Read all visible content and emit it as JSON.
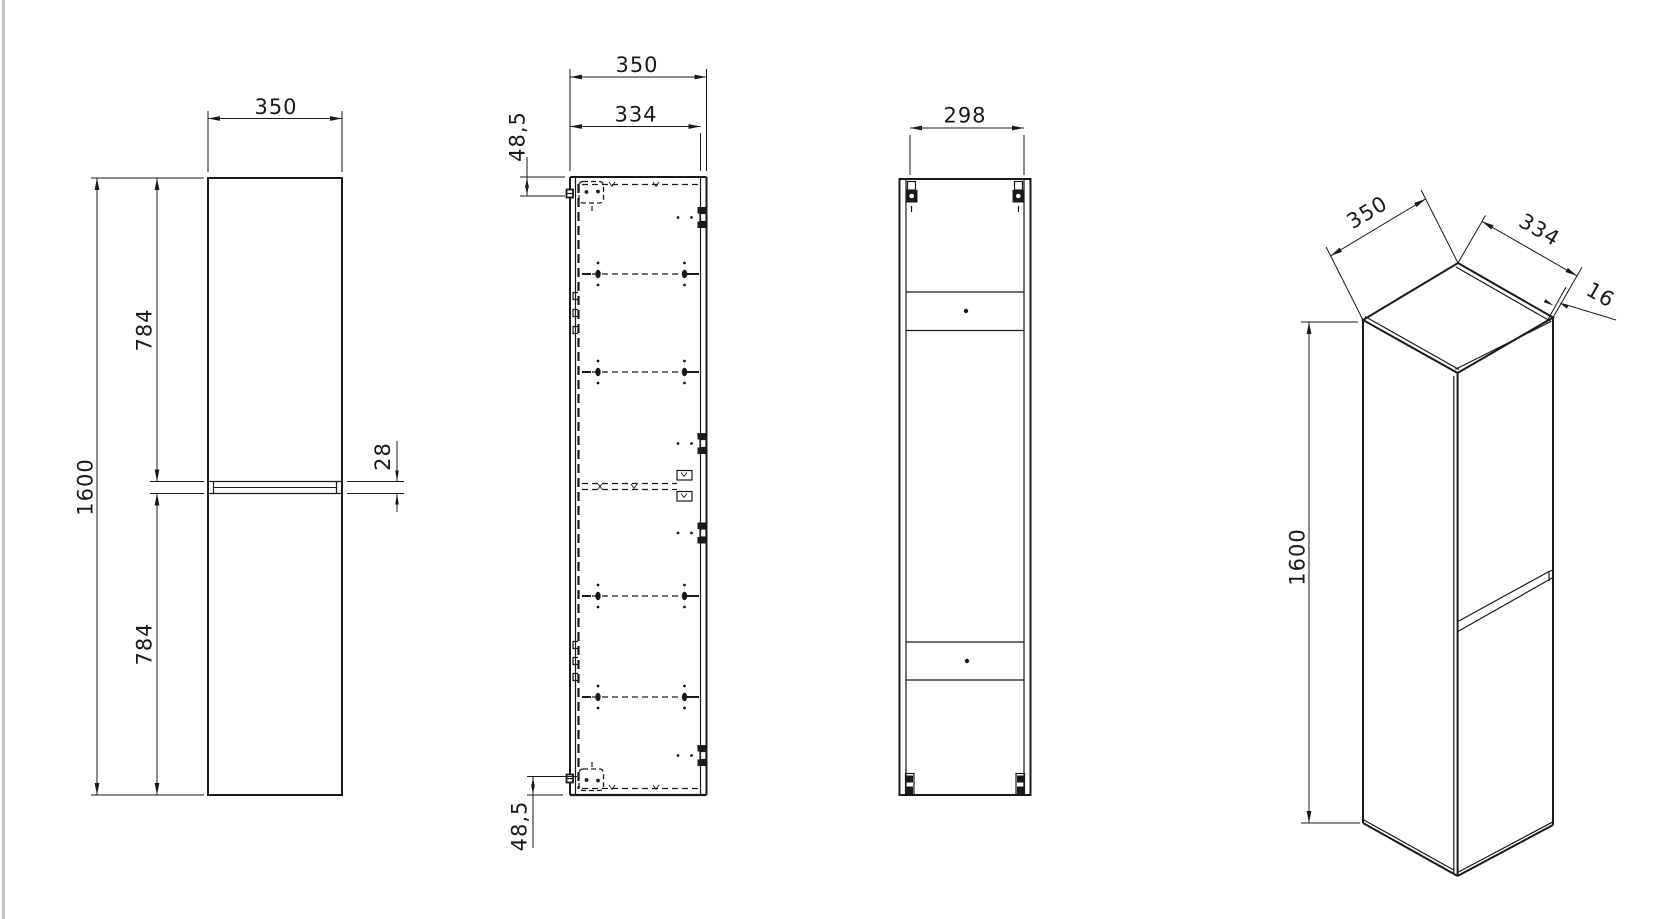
{
  "page": {
    "background": "#ffffff",
    "line_color": "#1a1a1a",
    "page_edge_color": "#c2c2c2"
  },
  "views": {
    "front": {
      "title": "front-elevation",
      "dims": {
        "width": "350",
        "height": "1600",
        "upper_door_height": "784",
        "lower_door_height": "784",
        "door_gap": "28"
      }
    },
    "section": {
      "title": "side-section",
      "dims": {
        "outer_depth": "350",
        "inner_depth": "334",
        "hinge_offset_top": "48,5",
        "hinge_offset_bottom": "48,5"
      }
    },
    "rear": {
      "title": "rear-elevation",
      "dims": {
        "mounting_span": "298"
      }
    },
    "perspective": {
      "title": "isometric-view",
      "dims": {
        "depth": "350",
        "door_width": "334",
        "panel_thickness": "16",
        "height": "1600"
      }
    }
  }
}
